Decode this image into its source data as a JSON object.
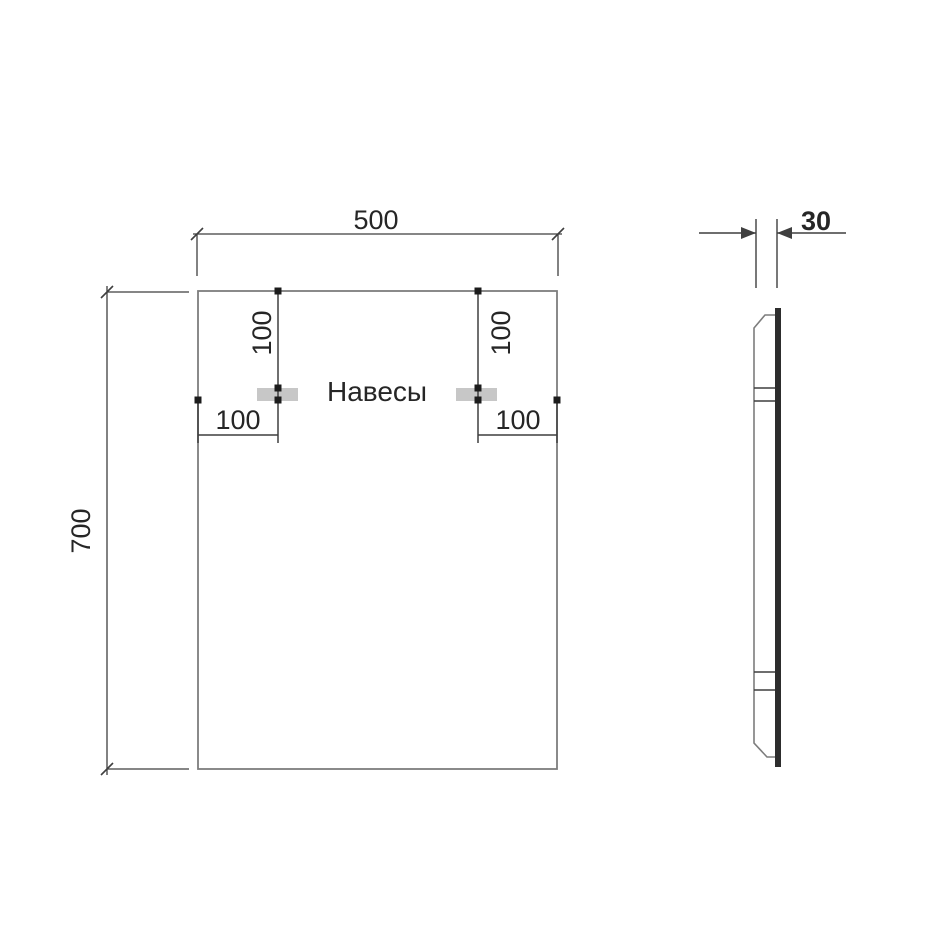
{
  "labels": {
    "width": "500",
    "height": "700",
    "depth": "30",
    "hanger_vertical_offset_left": "100",
    "hanger_vertical_offset_right": "100",
    "hanger_horizontal_offset_left": "100",
    "hanger_horizontal_offset_right": "100",
    "hangers": "Навесы"
  },
  "dimensions": {
    "front_width_mm": 500,
    "front_height_mm": 700,
    "depth_mm": 30,
    "hanger_offset_mm": 100
  },
  "colors": {
    "background": "#ffffff",
    "outline": "#7d7d7d",
    "dimension_line": "#3f3f3f",
    "text": "#262626",
    "hanger_fill": "#c7c7c7",
    "glass_fill": "#2d2d2d",
    "marker_fill": "#1c1c1c"
  }
}
